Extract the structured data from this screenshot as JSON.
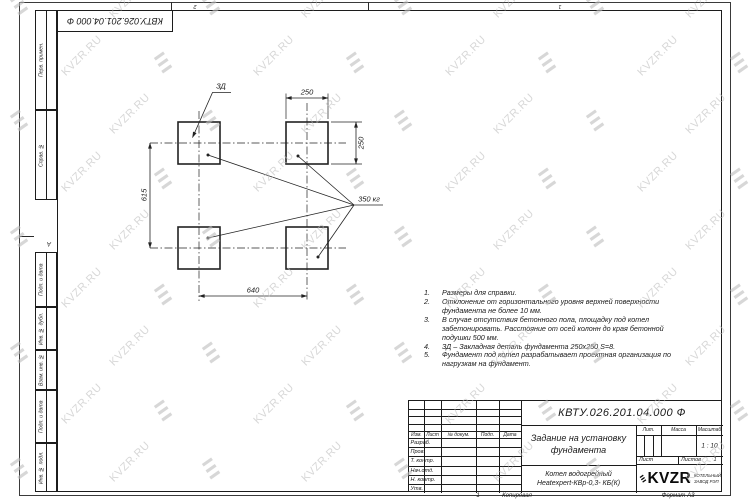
{
  "watermark": {
    "text": "KVZR.RU"
  },
  "border": {
    "stamp_doc_number": "КВТУ.026.201.04.000 Ф",
    "zone_top_left": "2",
    "zone_top_right": "1",
    "zone_left": "А",
    "left_stamps": [
      "Перв. примен.",
      "Справ. №",
      "Подп. и дата",
      "Инв. № дубл.",
      "Взам. инв. №",
      "Подп. и дата",
      "Инв. № подл."
    ]
  },
  "drawing": {
    "dim_top": "250",
    "dim_right": "250",
    "dim_left": "615",
    "dim_bottom": "640",
    "detail_label": "ЗД",
    "load_label": "350 кг"
  },
  "notes": [
    {
      "n": "1.",
      "t": "Размеры для справки."
    },
    {
      "n": "2.",
      "t": "Отклонение от горизонтального уровня верхней поверхности\nфундамента не более 10 мм."
    },
    {
      "n": "3.",
      "t": "В случае отсутствия бетонного пола, площадку под котел\nзабетонировать. Расстояние от осей колонн до края бетонной\nподушки 500 мм."
    },
    {
      "n": "4.",
      "t": "ЗД – Закладная деталь фундамента 250х250 S=8."
    },
    {
      "n": "5.",
      "t": "Фундамент под котел разрабатывает проектная организация по\nнагрузкам на фундамент."
    }
  ],
  "title_block": {
    "doc_number": "КВТУ.026.201.04.000 Ф",
    "title": "Задание на установку\nфундамента",
    "product": "Котел водогрейный\nHeatexpert-КВр-0,3- КБ(К)",
    "cols": [
      "Изм.",
      "Лист",
      "№ докум.",
      "Подп.",
      "Дата"
    ],
    "rows": [
      "Разраб.",
      "Пров.",
      "Т. контр.",
      "Нач.отд.",
      "Н. контр.",
      "Утв."
    ],
    "lit": "Лит.",
    "mass": "Масса",
    "scale": "Масштаб",
    "scale_value": "1 : 10",
    "sheet": "Лист",
    "sheets": "Листов",
    "sheets_value": "1",
    "logo": "KVZR",
    "logo_sub": "КОТЕЛЬНЫЙ\nЗАВОД РЭП",
    "footer_page": "1",
    "footer_copy": "Копировал",
    "footer_format": "Формат А3"
  }
}
